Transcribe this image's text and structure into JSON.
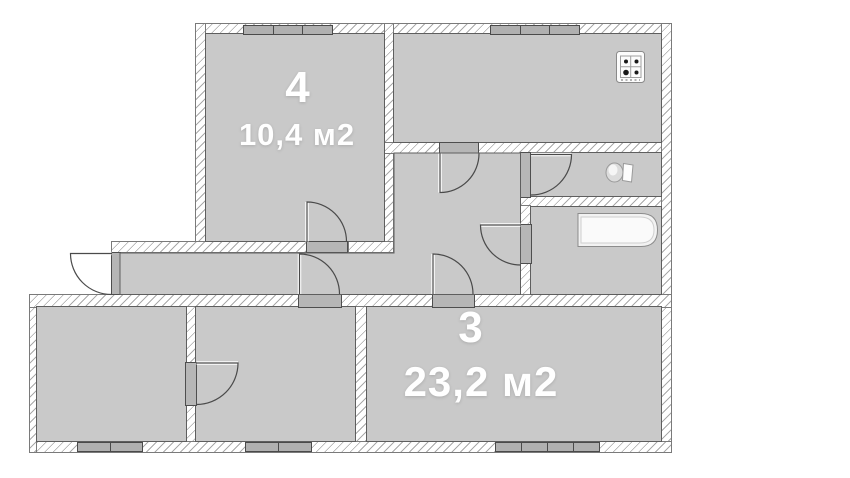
{
  "rooms": {
    "room4": {
      "number": "4",
      "area": "10,4 м2"
    },
    "room3": {
      "number": "3",
      "area": "23,2 м2"
    }
  },
  "fixtures": {
    "stove": "stove-icon",
    "toilet": "toilet-icon",
    "bathtub": "bathtub-icon"
  },
  "colors": {
    "room_fill": "#c9c9c9",
    "wall_hatch": "#a9a9a9",
    "outline": "#5e5e5e",
    "label_text": "#ffffff",
    "window_fill": "#b0b0b0",
    "jamb_fill": "#b6b6b6"
  }
}
